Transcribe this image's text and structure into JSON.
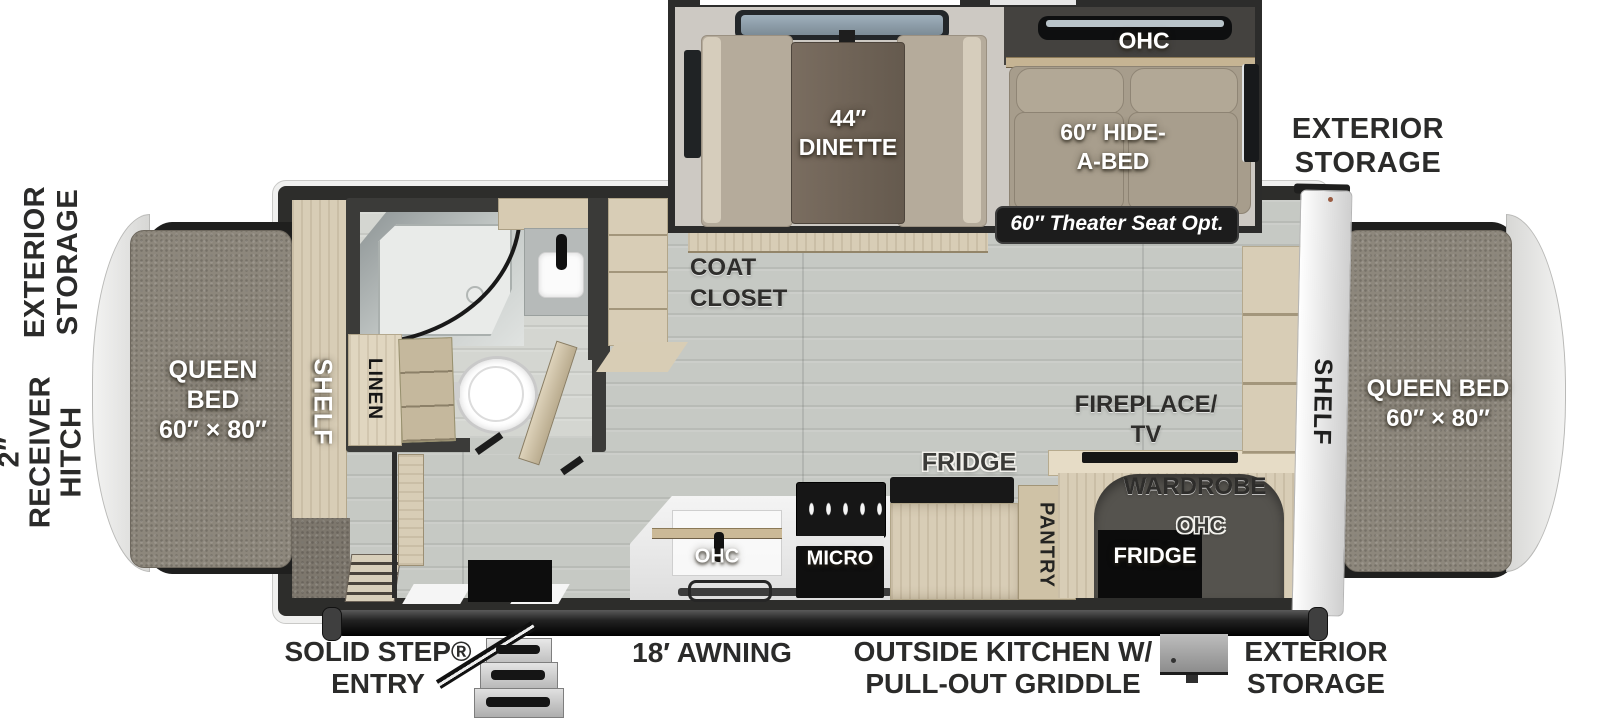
{
  "title": "Travel trailer floor plan",
  "colors": {
    "wall": "#2d2d2b",
    "floor": "#c2c5c0",
    "cabinet": "#d8cdb6",
    "carpet": "#8d877c",
    "counter": "#ececec",
    "appliance": "#141414",
    "badge_bg": "#1c1c1c",
    "platform": "#ededed",
    "sofa": "#a79d8c",
    "table": "#6e6257",
    "label_dark": "#2b2b2a"
  },
  "exterior_labels": {
    "left_storage": {
      "line1": "EXTERIOR",
      "line2": "STORAGE"
    },
    "hitch": {
      "line1": "2″",
      "line2": "RECEIVER",
      "line3": "HITCH"
    },
    "top_right_storage": {
      "line1": "EXTERIOR",
      "line2": "STORAGE"
    },
    "bottom_entry": {
      "line1": "SOLID STEP®",
      "line2": "ENTRY"
    },
    "bottom_awning": "18′ AWNING",
    "bottom_outside_kitchen": {
      "line1": "OUTSIDE KITCHEN W/",
      "line2": "PULL-OUT GRIDDLE"
    },
    "bottom_right_storage": {
      "line1": "EXTERIOR",
      "line2": "STORAGE"
    }
  },
  "slide_out": {
    "dinette": {
      "line1": "44″",
      "line2": "DINETTE"
    },
    "ohc": "OHC",
    "hide_a_bed": {
      "line1": "60″ HIDE-",
      "line2": "A-BED"
    },
    "theater_badge": "60″ Theater Seat Opt."
  },
  "bedroom_left": {
    "bed_line1": "QUEEN",
    "bed_line2": "BED",
    "bed_line3": "60″ × 80″",
    "shelf": "SHELF"
  },
  "bathroom": {
    "linen": "LINEN"
  },
  "living": {
    "coat_closet_line1": "COAT",
    "coat_closet_line2": "CLOSET"
  },
  "kitchen": {
    "ohc": "OHC",
    "micro": "MICRO",
    "fridge": "FRIDGE",
    "pantry": "PANTRY"
  },
  "entertainment": {
    "fireplace_line1": "FIREPLACE/",
    "fireplace_line2": "TV",
    "wardrobe": "WARDROBE",
    "ohc": "OHC",
    "fridge": "FRIDGE"
  },
  "bedroom_right": {
    "shelf": "SHELF",
    "bed_line1": "QUEEN BED",
    "bed_line2": "60″ × 80″"
  }
}
